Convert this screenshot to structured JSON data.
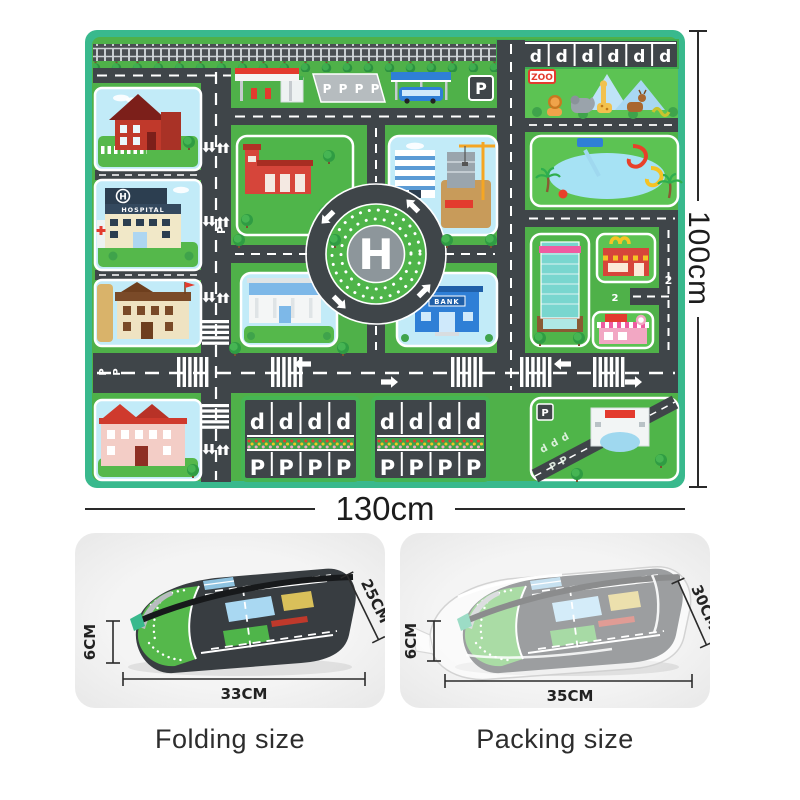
{
  "dimensions": {
    "height": "100cm",
    "width": "130cm"
  },
  "mat": {
    "letters": {
      "helipad": "H",
      "parking": "P",
      "parking_reversed": "d",
      "route": "2"
    },
    "signs": {
      "hospital": "HOSPITAL",
      "zoo": "ZOO",
      "bank": "BANK"
    },
    "colors": {
      "border": "#39b98d",
      "grass": "#4fb149",
      "road": "#3f4549",
      "sky_block": "#c2ebf8",
      "marking": "#ffffff"
    }
  },
  "folding": {
    "caption": "Folding size",
    "thickness": "6CM",
    "depth": "25CM",
    "width": "33CM"
  },
  "packing": {
    "caption": "Packing size",
    "thickness": "6CM",
    "depth": "30CM",
    "width": "35CM"
  }
}
